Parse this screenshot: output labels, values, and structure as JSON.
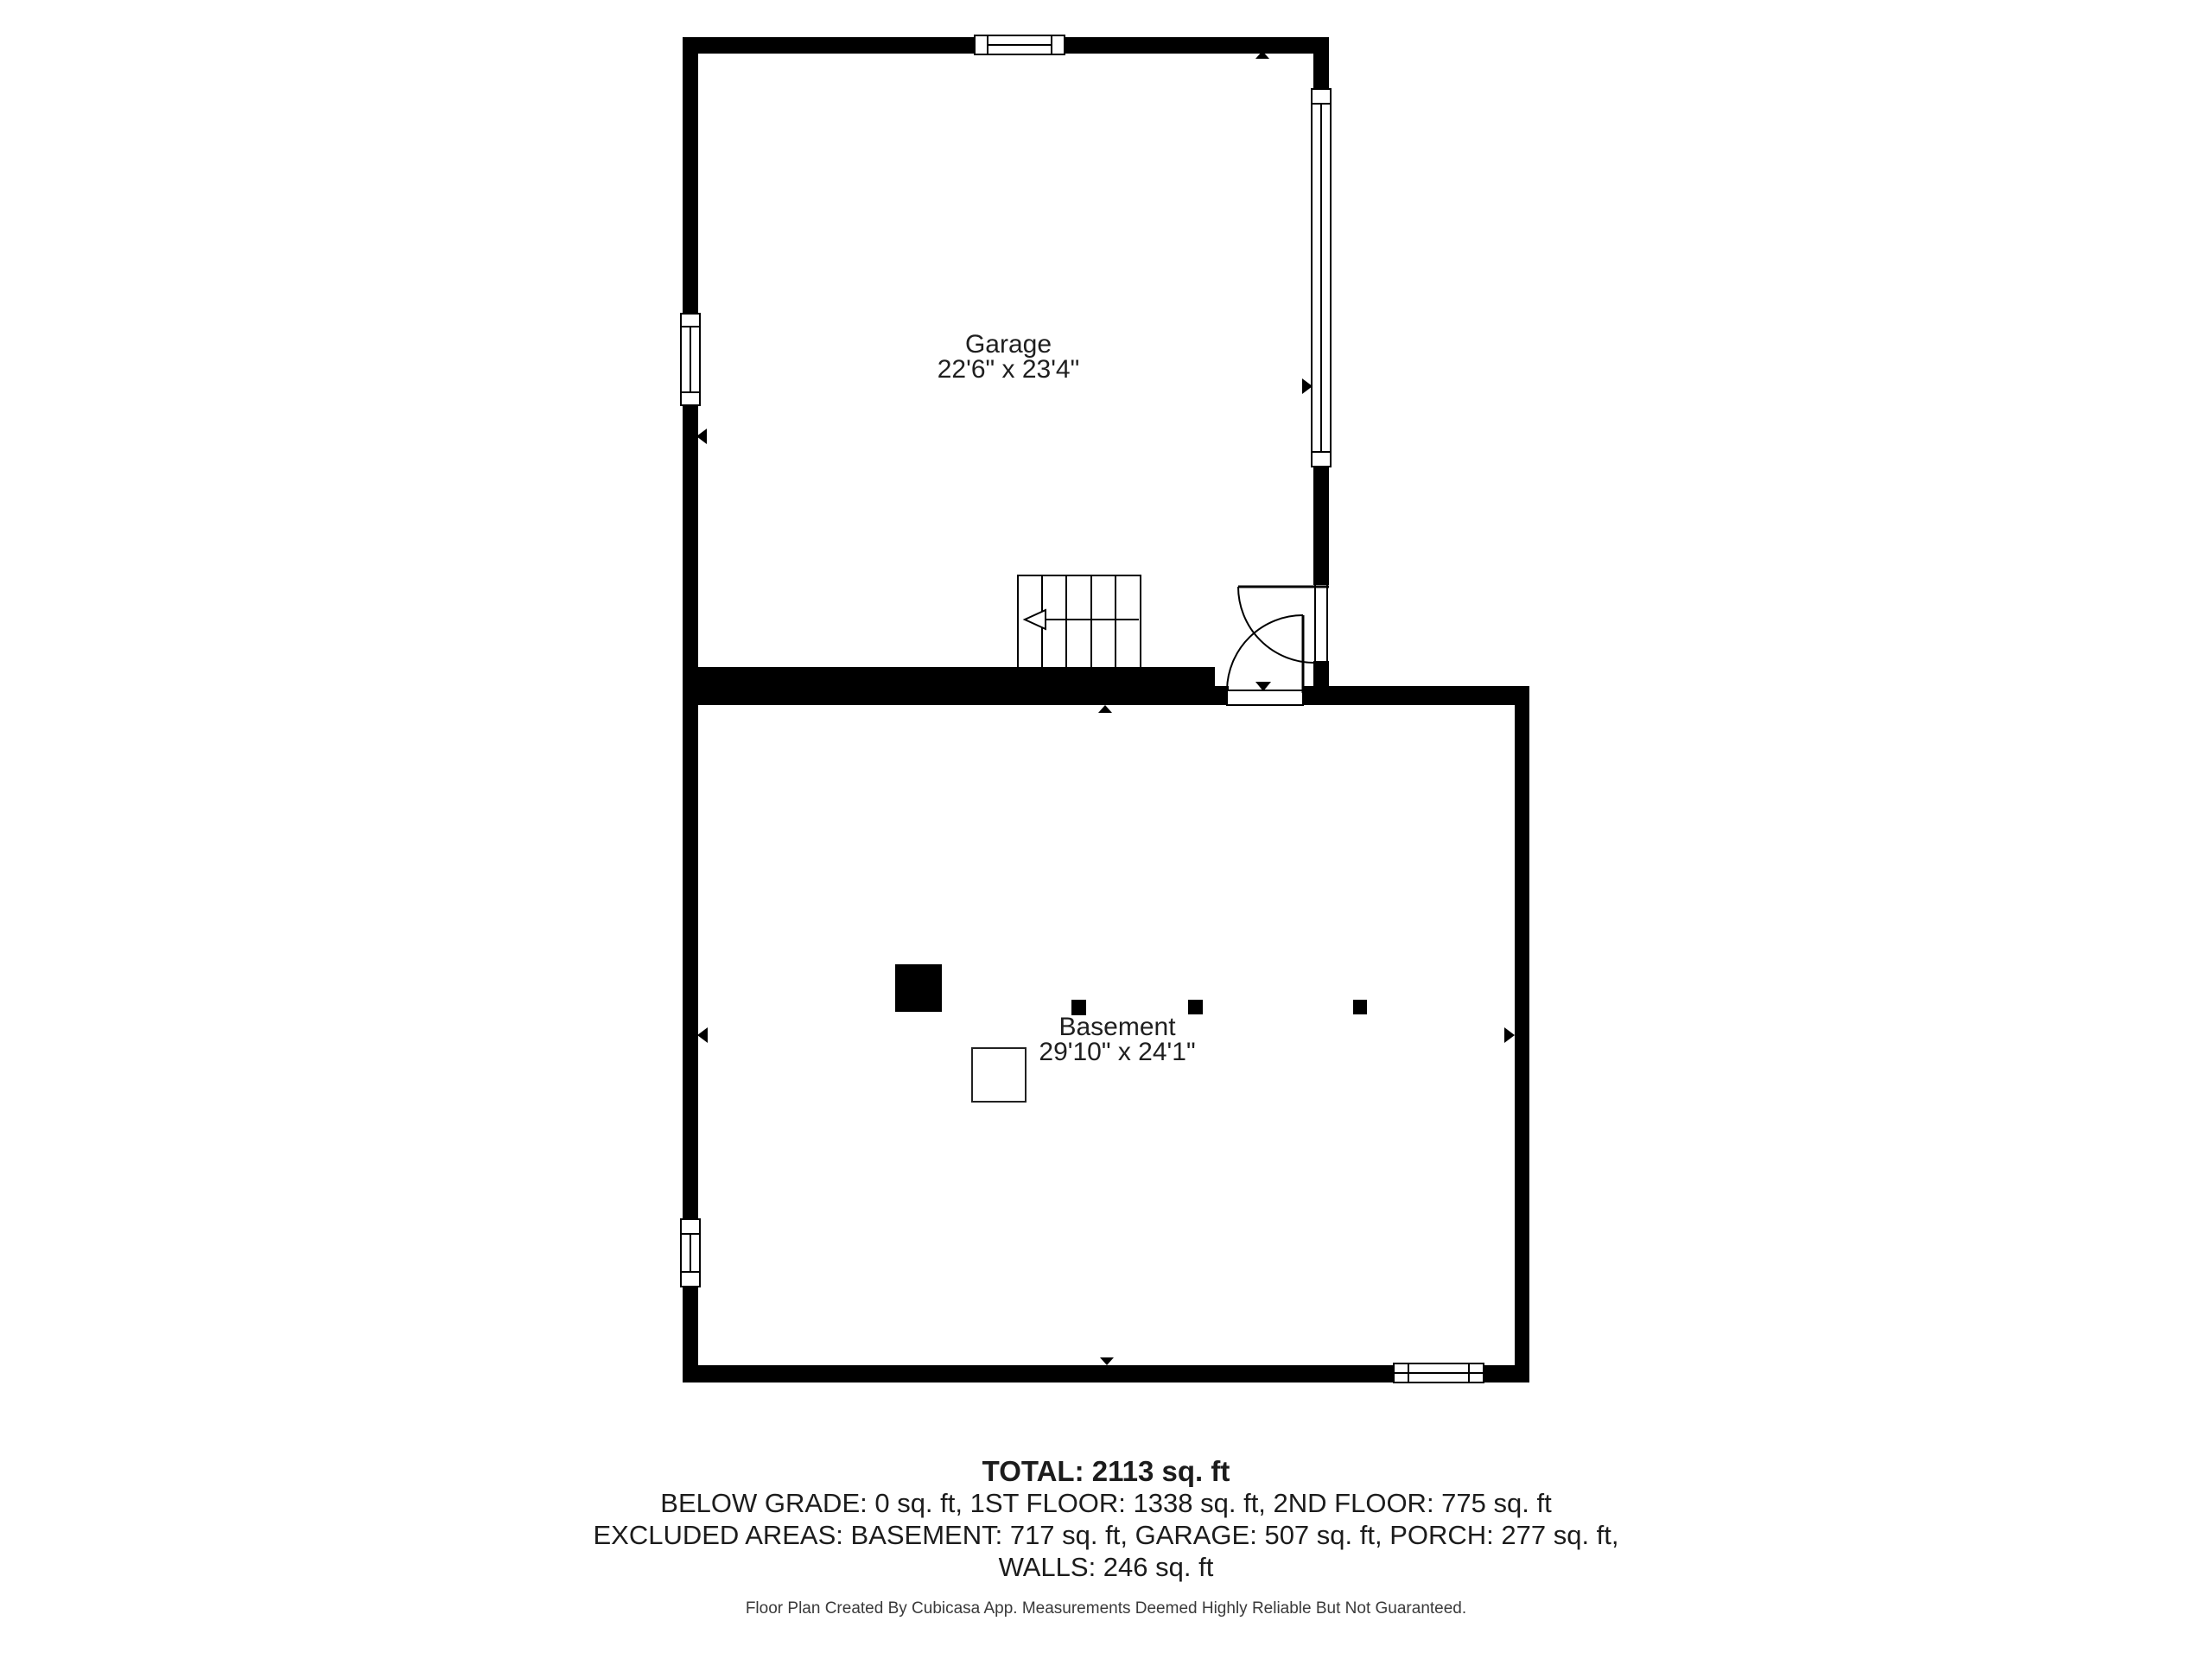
{
  "floor_plan": {
    "rooms": [
      {
        "name": "Garage",
        "dimensions": "22'6\" x 23'4\""
      },
      {
        "name": "Basement",
        "dimensions": "29'10\" x 24'1\""
      }
    ]
  },
  "summary": {
    "total": "TOTAL: 2113 sq. ft",
    "floors": "BELOW GRADE: 0 sq. ft, 1ST FLOOR: 1338 sq. ft, 2ND FLOOR: 775 sq. ft",
    "excluded": "EXCLUDED AREAS: BASEMENT: 717 sq. ft, GARAGE: 507 sq. ft, PORCH: 277 sq. ft,",
    "walls": "WALLS: 246 sq. ft"
  },
  "footer": {
    "disclaimer": "Floor Plan Created By Cubicasa App. Measurements Deemed Highly Reliable But Not Guaranteed."
  },
  "colors": {
    "wall": "#000000",
    "background": "#ffffff",
    "label_text": "#1f1f1f",
    "summary_text": "#1c1c1c",
    "footer_text": "#3a3a3a"
  },
  "icons": {
    "wall_arrow_up": "▲",
    "wall_arrow_down": "▼",
    "wall_arrow_left": "◄",
    "wall_arrow_right": "►",
    "stair_direction_arrow": "←"
  }
}
